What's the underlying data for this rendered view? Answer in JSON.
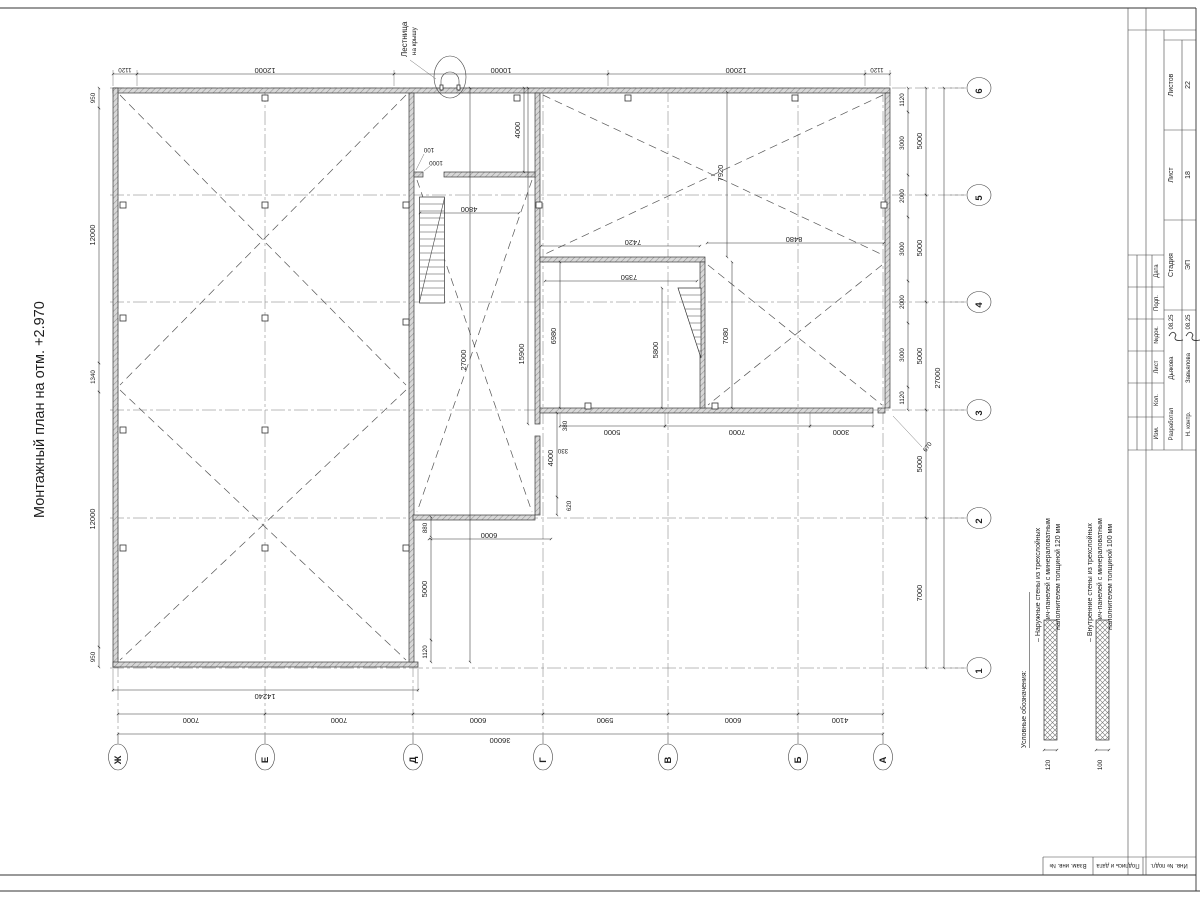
{
  "sheet_title": "Монтажный план на отм. +2.970",
  "callout": {
    "line1": "Лестница",
    "line2": "на крышу"
  },
  "axes": {
    "letters": [
      "Ж",
      "Е",
      "Д",
      "Г",
      "В",
      "Б",
      "А"
    ],
    "numbers": [
      "6",
      "5",
      "4",
      "3",
      "2",
      "1"
    ]
  },
  "dims": {
    "top": [
      "1120",
      "12000",
      "10000",
      "12000",
      "1120"
    ],
    "left": [
      "950",
      "12000",
      "1340",
      "12000",
      "950"
    ],
    "right_inner": [
      "1120",
      "3000",
      "2000",
      "3000",
      "2000",
      "3000",
      "1120"
    ],
    "right_mid": [
      "5000",
      "5000",
      "5000",
      "5000",
      "7000"
    ],
    "right_total": "27000",
    "bottom_block": "14240",
    "bottom_bays": [
      "7000",
      "7000",
      "6000",
      "5900",
      "6000",
      "4100"
    ],
    "bottom_total": "36000",
    "interior": {
      "corridor_width_top": "4000",
      "door_offset": "100",
      "door_width": "1000",
      "corridor_span": "4800",
      "hall_height": "7920",
      "room_w1": "7420",
      "room_w2": "7350",
      "room_w3": "8480",
      "room_h1": "6980",
      "room_h2": "7080",
      "stair_h": "5800",
      "wall_len": "15900",
      "corridor_total": "27000",
      "off1": "380",
      "off2": "330",
      "seg4000": "4000",
      "off3": "620",
      "seg880": "880",
      "seg6000": "6000",
      "row5000": "5000",
      "row7000": "7000",
      "row3000": "3000",
      "left5000": "5000",
      "left1120": "1120",
      "gap670": "670"
    }
  },
  "legend": {
    "title": "Условные обозначения:",
    "item1": {
      "l1": "– Наружные стены из трехслойных",
      "l2": "сэндвич-панелей с минераловатным",
      "l3": "наполнителем толщиной 120 мм",
      "thickness": "120"
    },
    "item2": {
      "l1": "– Внутренние стены из трехслойных",
      "l2": "сэндвич-панелей с минераловатным",
      "l3": "наполнителем толщиной 100 мм",
      "thickness": "100"
    }
  },
  "titleblock": {
    "stage_label": "Стадия",
    "stage": "ЭП",
    "sheet_label": "Лист",
    "sheet": "18",
    "sheets_label": "Листов",
    "sheets": "22",
    "col_date": "Дата",
    "col_sign": "Подп.",
    "col_doc": "№док.",
    "col_sheet": "Лист",
    "col_qty": "Кол.",
    "col_rev": "Изм.",
    "dev_label": "Разработал",
    "dev_name": "Дьякова",
    "dev_date": "08.25",
    "chk_label": "Н. контр.",
    "chk_name": "Завьялова",
    "chk_date": "08.25"
  },
  "side_strip": {
    "c1": "Взам. инв. №",
    "c2": "Подпись и дата",
    "c3": "Инв. № подл."
  }
}
